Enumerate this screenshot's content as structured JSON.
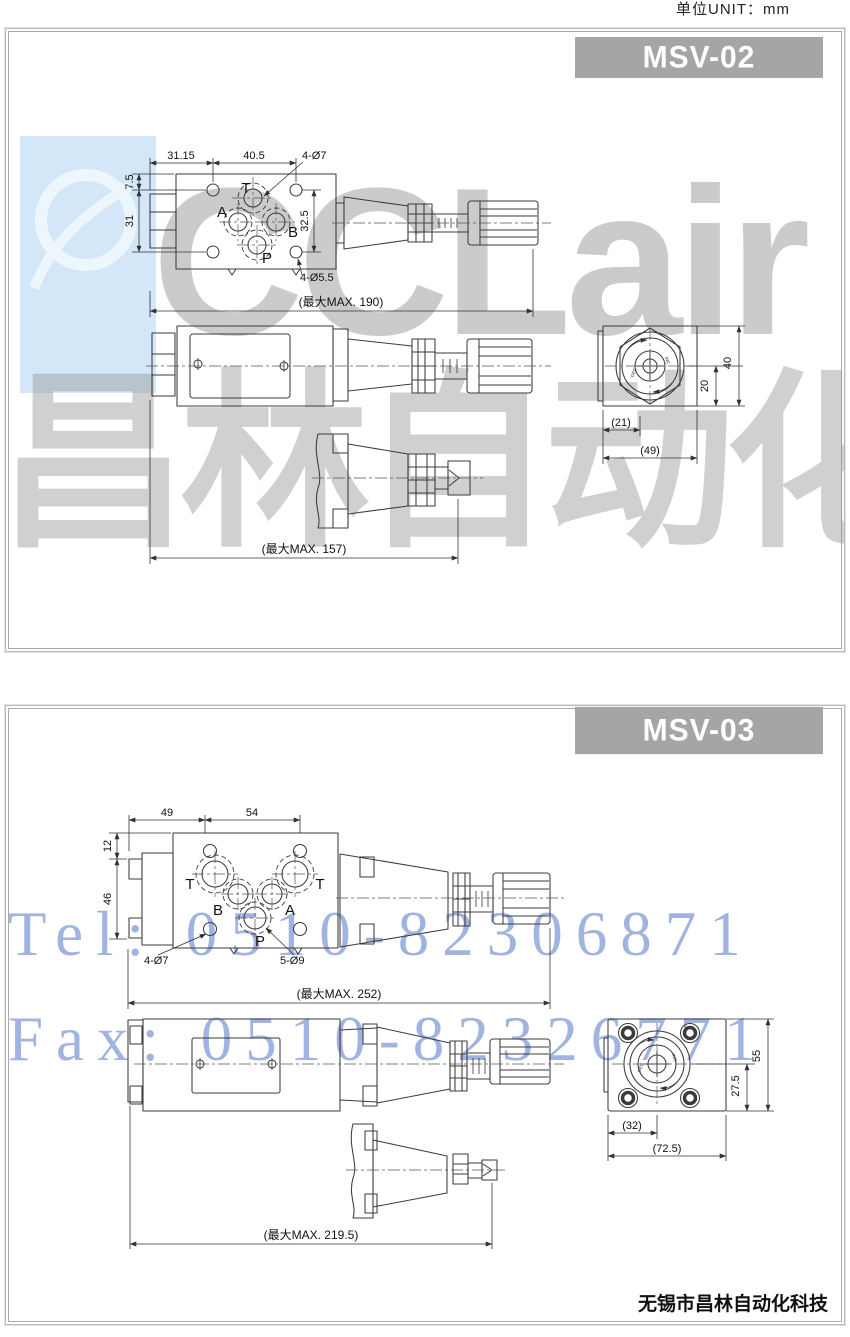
{
  "header": {
    "unit_label": "单位UNIT：mm"
  },
  "watermark": {
    "logo_text": "CCLair",
    "logo_cn": "昌林自动化",
    "tel": "Tel: 0510-82306871",
    "fax": "Fax: 0510-82326771"
  },
  "footer": {
    "company": "无锡市昌林自动化科技"
  },
  "msv02": {
    "model": "MSV-02",
    "ports": {
      "t": "T",
      "a": "A",
      "b": "B",
      "p": "P"
    },
    "knob": {
      "dec": "DEC",
      "inc": "INC"
    },
    "dims": {
      "w1": "31.15",
      "w2": "40.5",
      "holes_top": "4-Ø7",
      "h1": "7.5",
      "h2": "31",
      "h3": "32.5",
      "holes_bottom": "4-Ø5.5",
      "max_total": "(最大MAX. 190)",
      "max_handle": "(最大MAX. 157)",
      "end_w_half": "(21)",
      "end_w_full": "(49)",
      "end_h_half": "20",
      "end_h_full": "40"
    }
  },
  "msv03": {
    "model": "MSV-03",
    "ports": {
      "t1": "T",
      "t2": "T",
      "b": "B",
      "a": "A",
      "p": "P"
    },
    "knob": {
      "dec": "DEC",
      "inc": "INC"
    },
    "dims": {
      "w1": "49",
      "w2": "54",
      "h1": "12",
      "h2": "46",
      "holes_small": "4-Ø7",
      "holes_large": "5-Ø9",
      "max_total": "(最大MAX. 252)",
      "max_handle": "(最大MAX. 219.5)",
      "end_w_half": "(32)",
      "end_w_full": "(72.5)",
      "end_h_half": "27.5",
      "end_h_full": "55"
    }
  }
}
